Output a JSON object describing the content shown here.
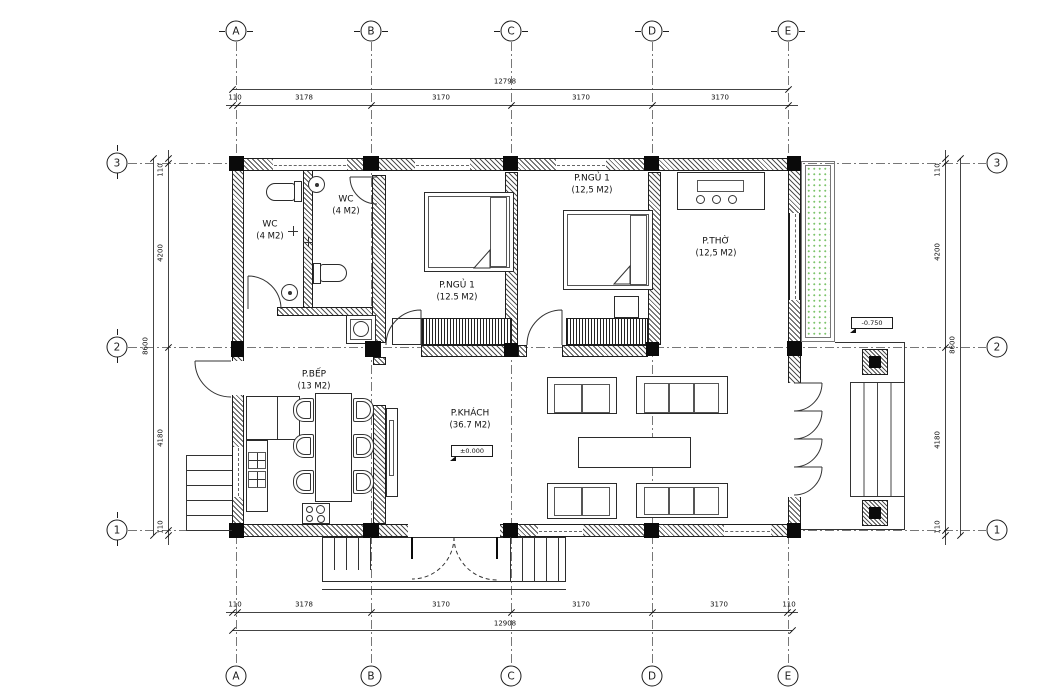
{
  "drawing": {
    "type": "floor-plan",
    "axes": {
      "cols": [
        "A",
        "B",
        "C",
        "D",
        "E"
      ],
      "rows": [
        "3",
        "2",
        "1"
      ]
    },
    "dims": {
      "top": {
        "total": "12798",
        "segments": [
          "110",
          "3178",
          "3170",
          "3170",
          "3170"
        ]
      },
      "bottom": {
        "total": "12908",
        "segments": [
          "110",
          "3178",
          "3170",
          "3170",
          "3170",
          "110"
        ]
      },
      "left": {
        "total": "8600",
        "segments": [
          "110",
          "4200",
          "4180",
          "110"
        ]
      },
      "right": {
        "total": "8600",
        "segments": [
          "110",
          "4200",
          "4180",
          "110"
        ]
      }
    },
    "rooms": {
      "wc1": {
        "name": "WC",
        "area": "(4 M2)"
      },
      "wc2": {
        "name": "WC",
        "area": "(4 M2)"
      },
      "bedroom1": {
        "name": "P.NGỦ 1",
        "area": "(12.5 M2)"
      },
      "bedroom2": {
        "name": "P.NGỦ 1",
        "area": "(12,5 M2)"
      },
      "worship": {
        "name": "P.THỜ",
        "area": "(12,5 M2)"
      },
      "kitchen": {
        "name": "P.BẾP",
        "area": "(13 M2)"
      },
      "living": {
        "name": "P.KHÁCH",
        "area": "(36.7 M2)"
      }
    },
    "levels": {
      "living": "±0.000",
      "porch": "-0.750"
    },
    "colors": {
      "line": "#222222",
      "hatch": "#6e6e6e",
      "column": "#0a0a0a",
      "planter_green": "#7cc46b",
      "background": "#ffffff"
    }
  }
}
